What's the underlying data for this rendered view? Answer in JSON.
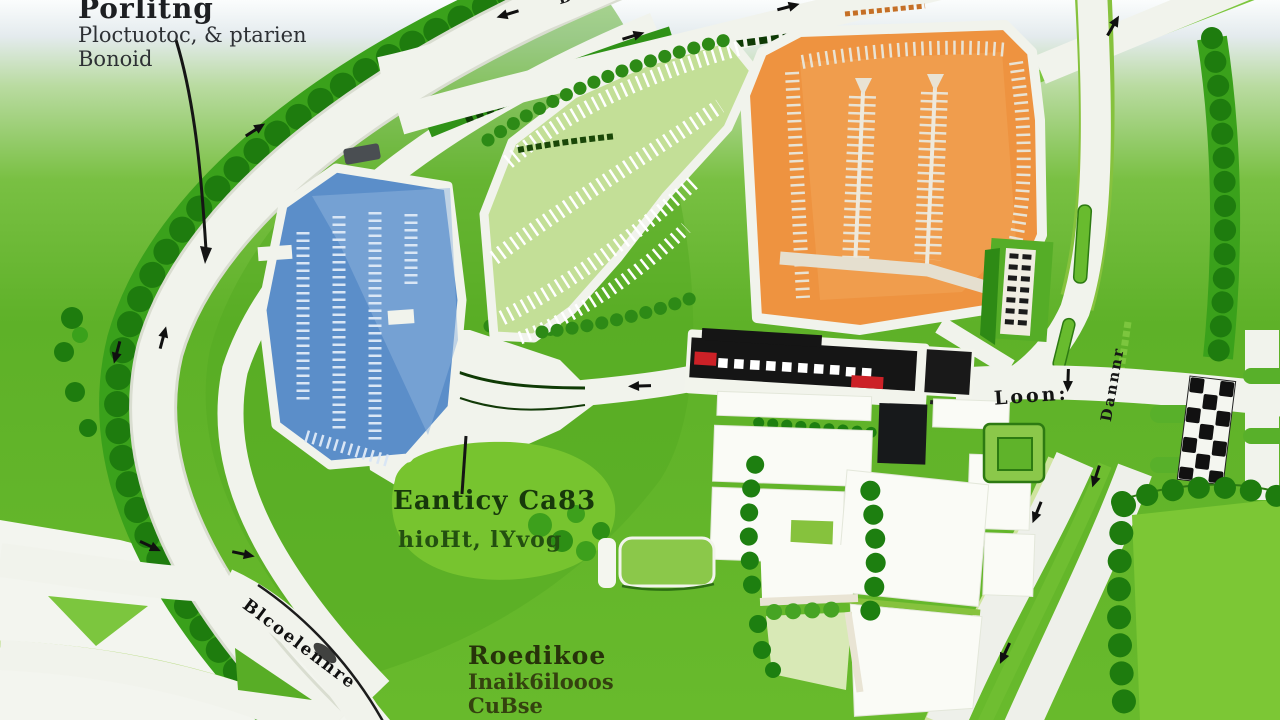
{
  "labels": {
    "parking": {
      "title": "Porlitng",
      "line2": "Ploctuotoc, & ptarien",
      "line3": "Bonoid"
    },
    "entrance": {
      "title": "Eanticy Ca83",
      "subtitle": "hioHt, lYvog"
    },
    "racecourse": {
      "title": "Roedikoe",
      "line2": "Inaik6ilooos",
      "line3": "CuBse"
    },
    "roads": {
      "top": "Bonnot",
      "right_junction": "Loon:",
      "right_vertical": "Dannnr",
      "bottom_left": "Blcoelennre"
    }
  },
  "colors": {
    "lot_blue": "#5b8ec9",
    "lot_blue_light": "#8fb3dd",
    "lot_green": "#c3df97",
    "lot_orange": "#ee9340",
    "grandstand_black": "#151515",
    "grandstand_red": "#cc2127",
    "road_white": "#f1f3ec",
    "grass_green": "#62b42a",
    "field_green": "#7cc735",
    "tree_dark": "#1e7c0e",
    "tree_mid": "#3aa11b"
  }
}
